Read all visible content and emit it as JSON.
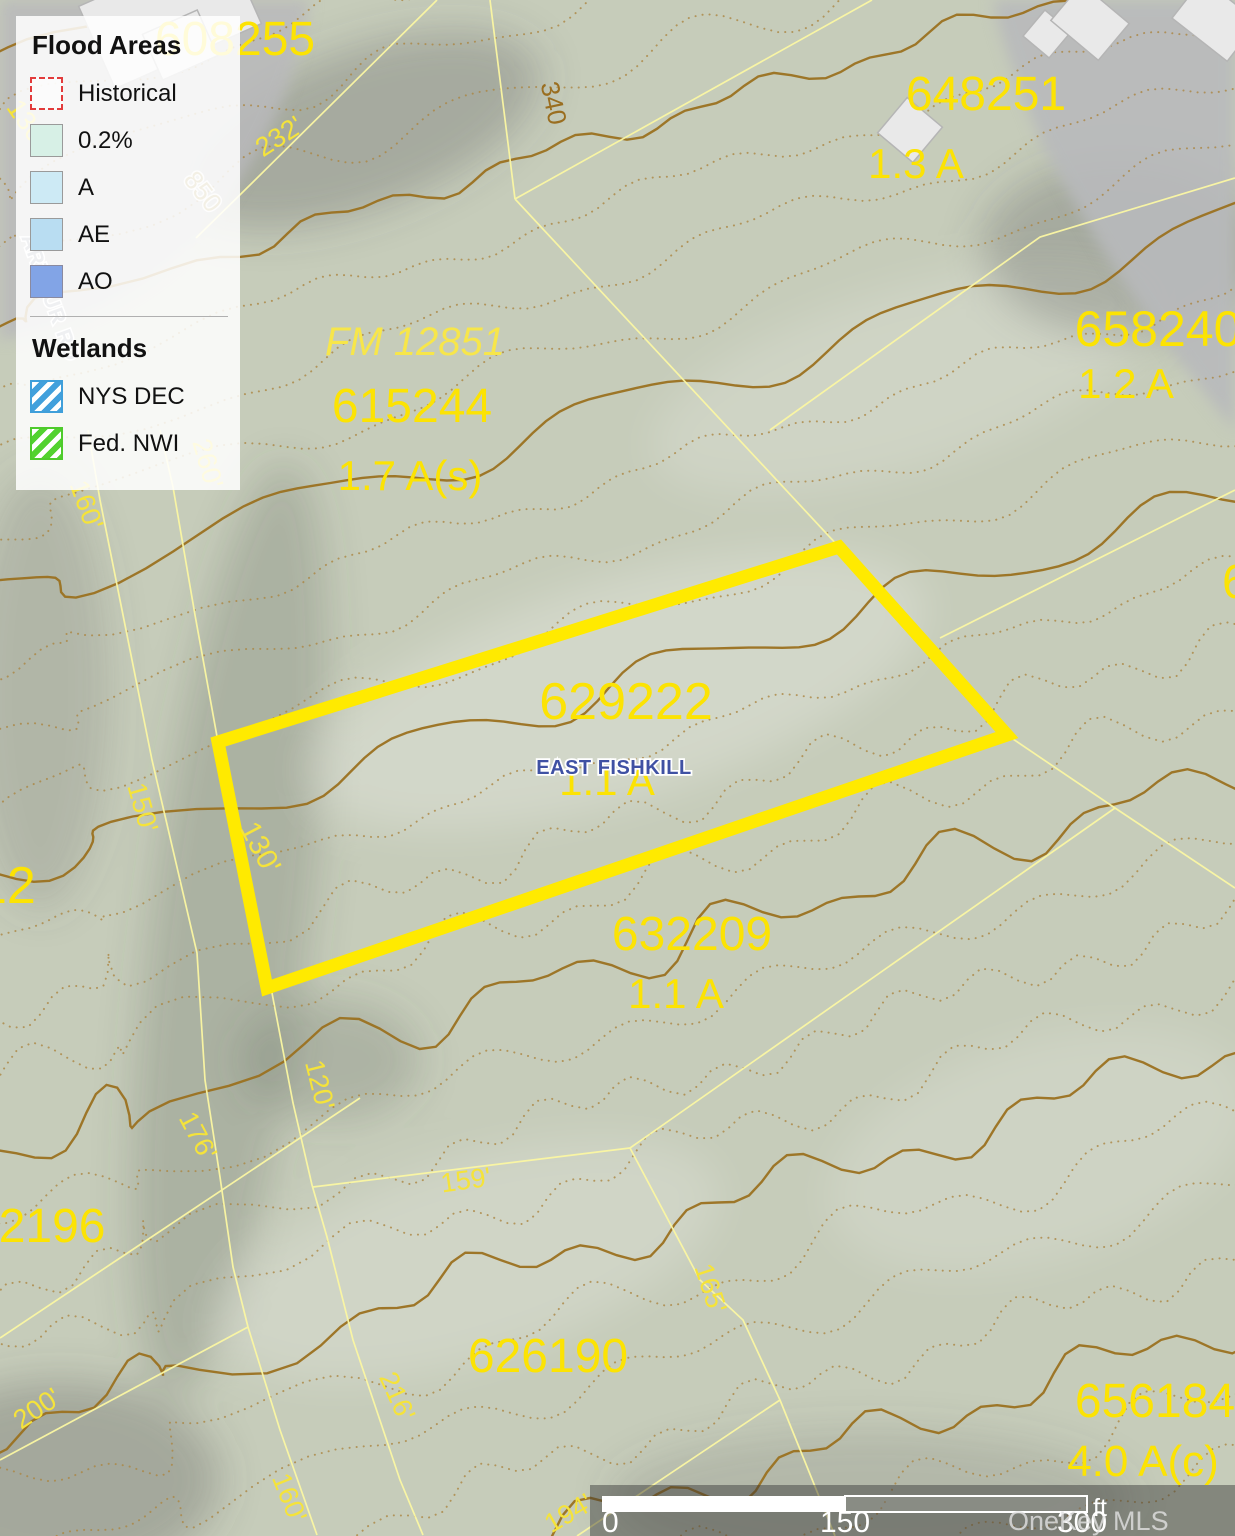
{
  "legend": {
    "sections": [
      {
        "title": "Flood Areas",
        "items": [
          {
            "label": "Historical"
          },
          {
            "label": "0.2%"
          },
          {
            "label": "A"
          },
          {
            "label": "AE"
          },
          {
            "label": "AO"
          }
        ]
      },
      {
        "title": "Wetlands",
        "items": [
          {
            "label": "NYS DEC"
          },
          {
            "label": "Fed. NWI"
          }
        ]
      }
    ]
  },
  "map": {
    "town": "EAST FISHKILL",
    "road": "ARTHUR RD",
    "parcels": {
      "p608255": {
        "id": "608255"
      },
      "p648251": {
        "id": "648251",
        "area": "1.3 A"
      },
      "p658240": {
        "id": "658240",
        "area": "1.2 A"
      },
      "p615244": {
        "id": "615244",
        "area": "1.7 A(s)",
        "plat": "FM 12851"
      },
      "p629222": {
        "id": "629222",
        "area": "1.1 A"
      },
      "p632209": {
        "id": "632209",
        "area": "1.1 A"
      },
      "p626190": {
        "id": "626190"
      },
      "p656184": {
        "id": "656184",
        "area": "4.0 A(c)"
      },
      "p02196": {
        "id": "02196"
      },
      "p12": {
        "id": "12"
      },
      "p6": {
        "id": "6"
      }
    },
    "dims": {
      "d232": "232'",
      "d130a": "130'",
      "d260": "260'",
      "d160u": "160'",
      "d150": "150'",
      "d130w": "130'",
      "d120": "120'",
      "d176": "176'",
      "d159": "159'",
      "d165": "165'",
      "d200": "200'",
      "d160l": "160'",
      "d216": "216'",
      "d194": "194'"
    },
    "contour_labels": {
      "c340": "340",
      "c850": "850"
    }
  },
  "scalebar": {
    "zero": "0",
    "mid": "150",
    "end": "300",
    "unit": "ft"
  },
  "watermark": "OneKey MLS",
  "colors": {
    "highlight": "#ffea00",
    "parcel_line": "#fbf7a3",
    "label_yellow": "#fce303",
    "contour": "#9b7120",
    "town_blue": "#3f51a3"
  }
}
